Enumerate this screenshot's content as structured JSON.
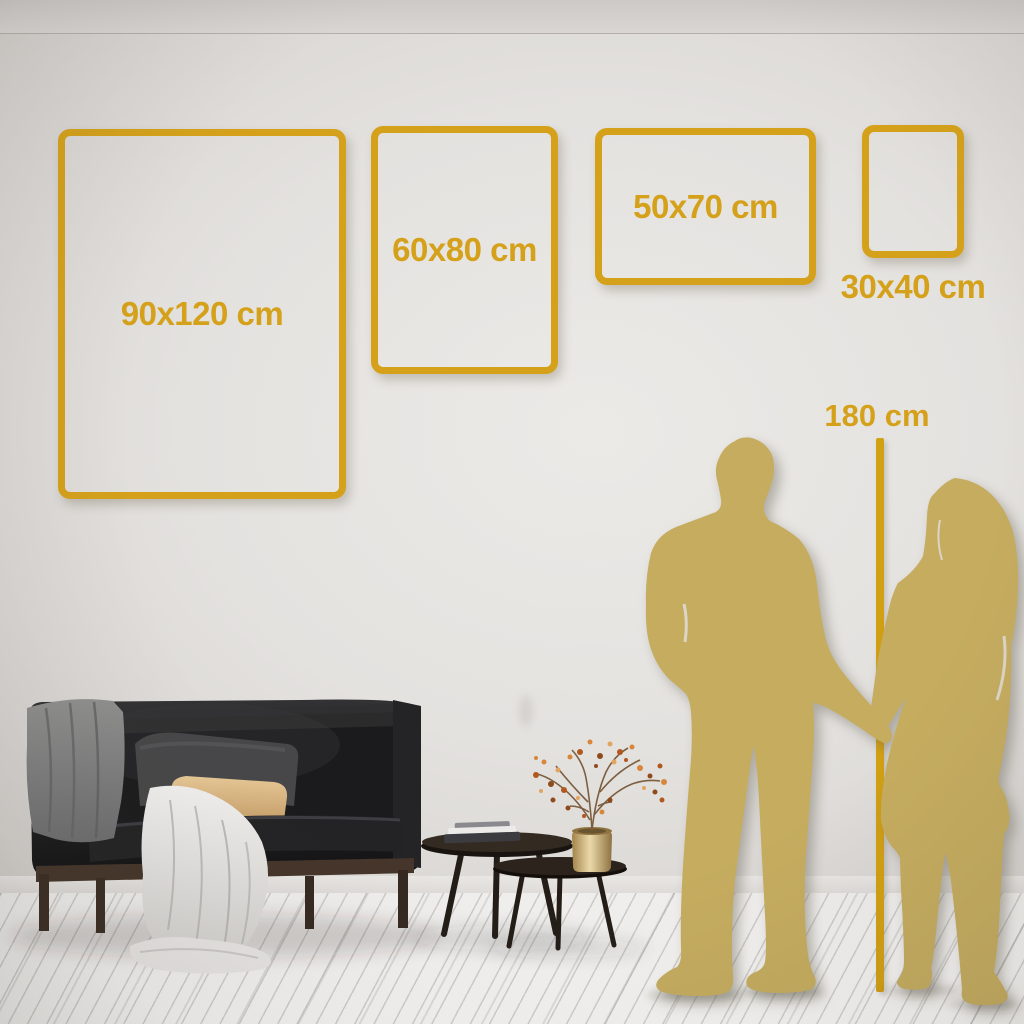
{
  "size_guide": {
    "frames": [
      {
        "label": "90x120 cm"
      },
      {
        "label": "60x80 cm"
      },
      {
        "label": "50x70 cm"
      },
      {
        "label": "30x40 cm"
      }
    ],
    "height_reference": {
      "label": "180 cm"
    }
  },
  "colors": {
    "accent_gold": "#D5A11B",
    "ruler_gold": "#D2A013",
    "silhouette_gold": "#C5AC5F",
    "wall": "#E4E2DF",
    "floor": "#F3F2F0"
  },
  "icons": [
    "man-silhouette",
    "woman-silhouette",
    "height-ruler-line",
    "sofa-illustration",
    "coffee-tables-illustration",
    "plant-vase-illustration"
  ]
}
